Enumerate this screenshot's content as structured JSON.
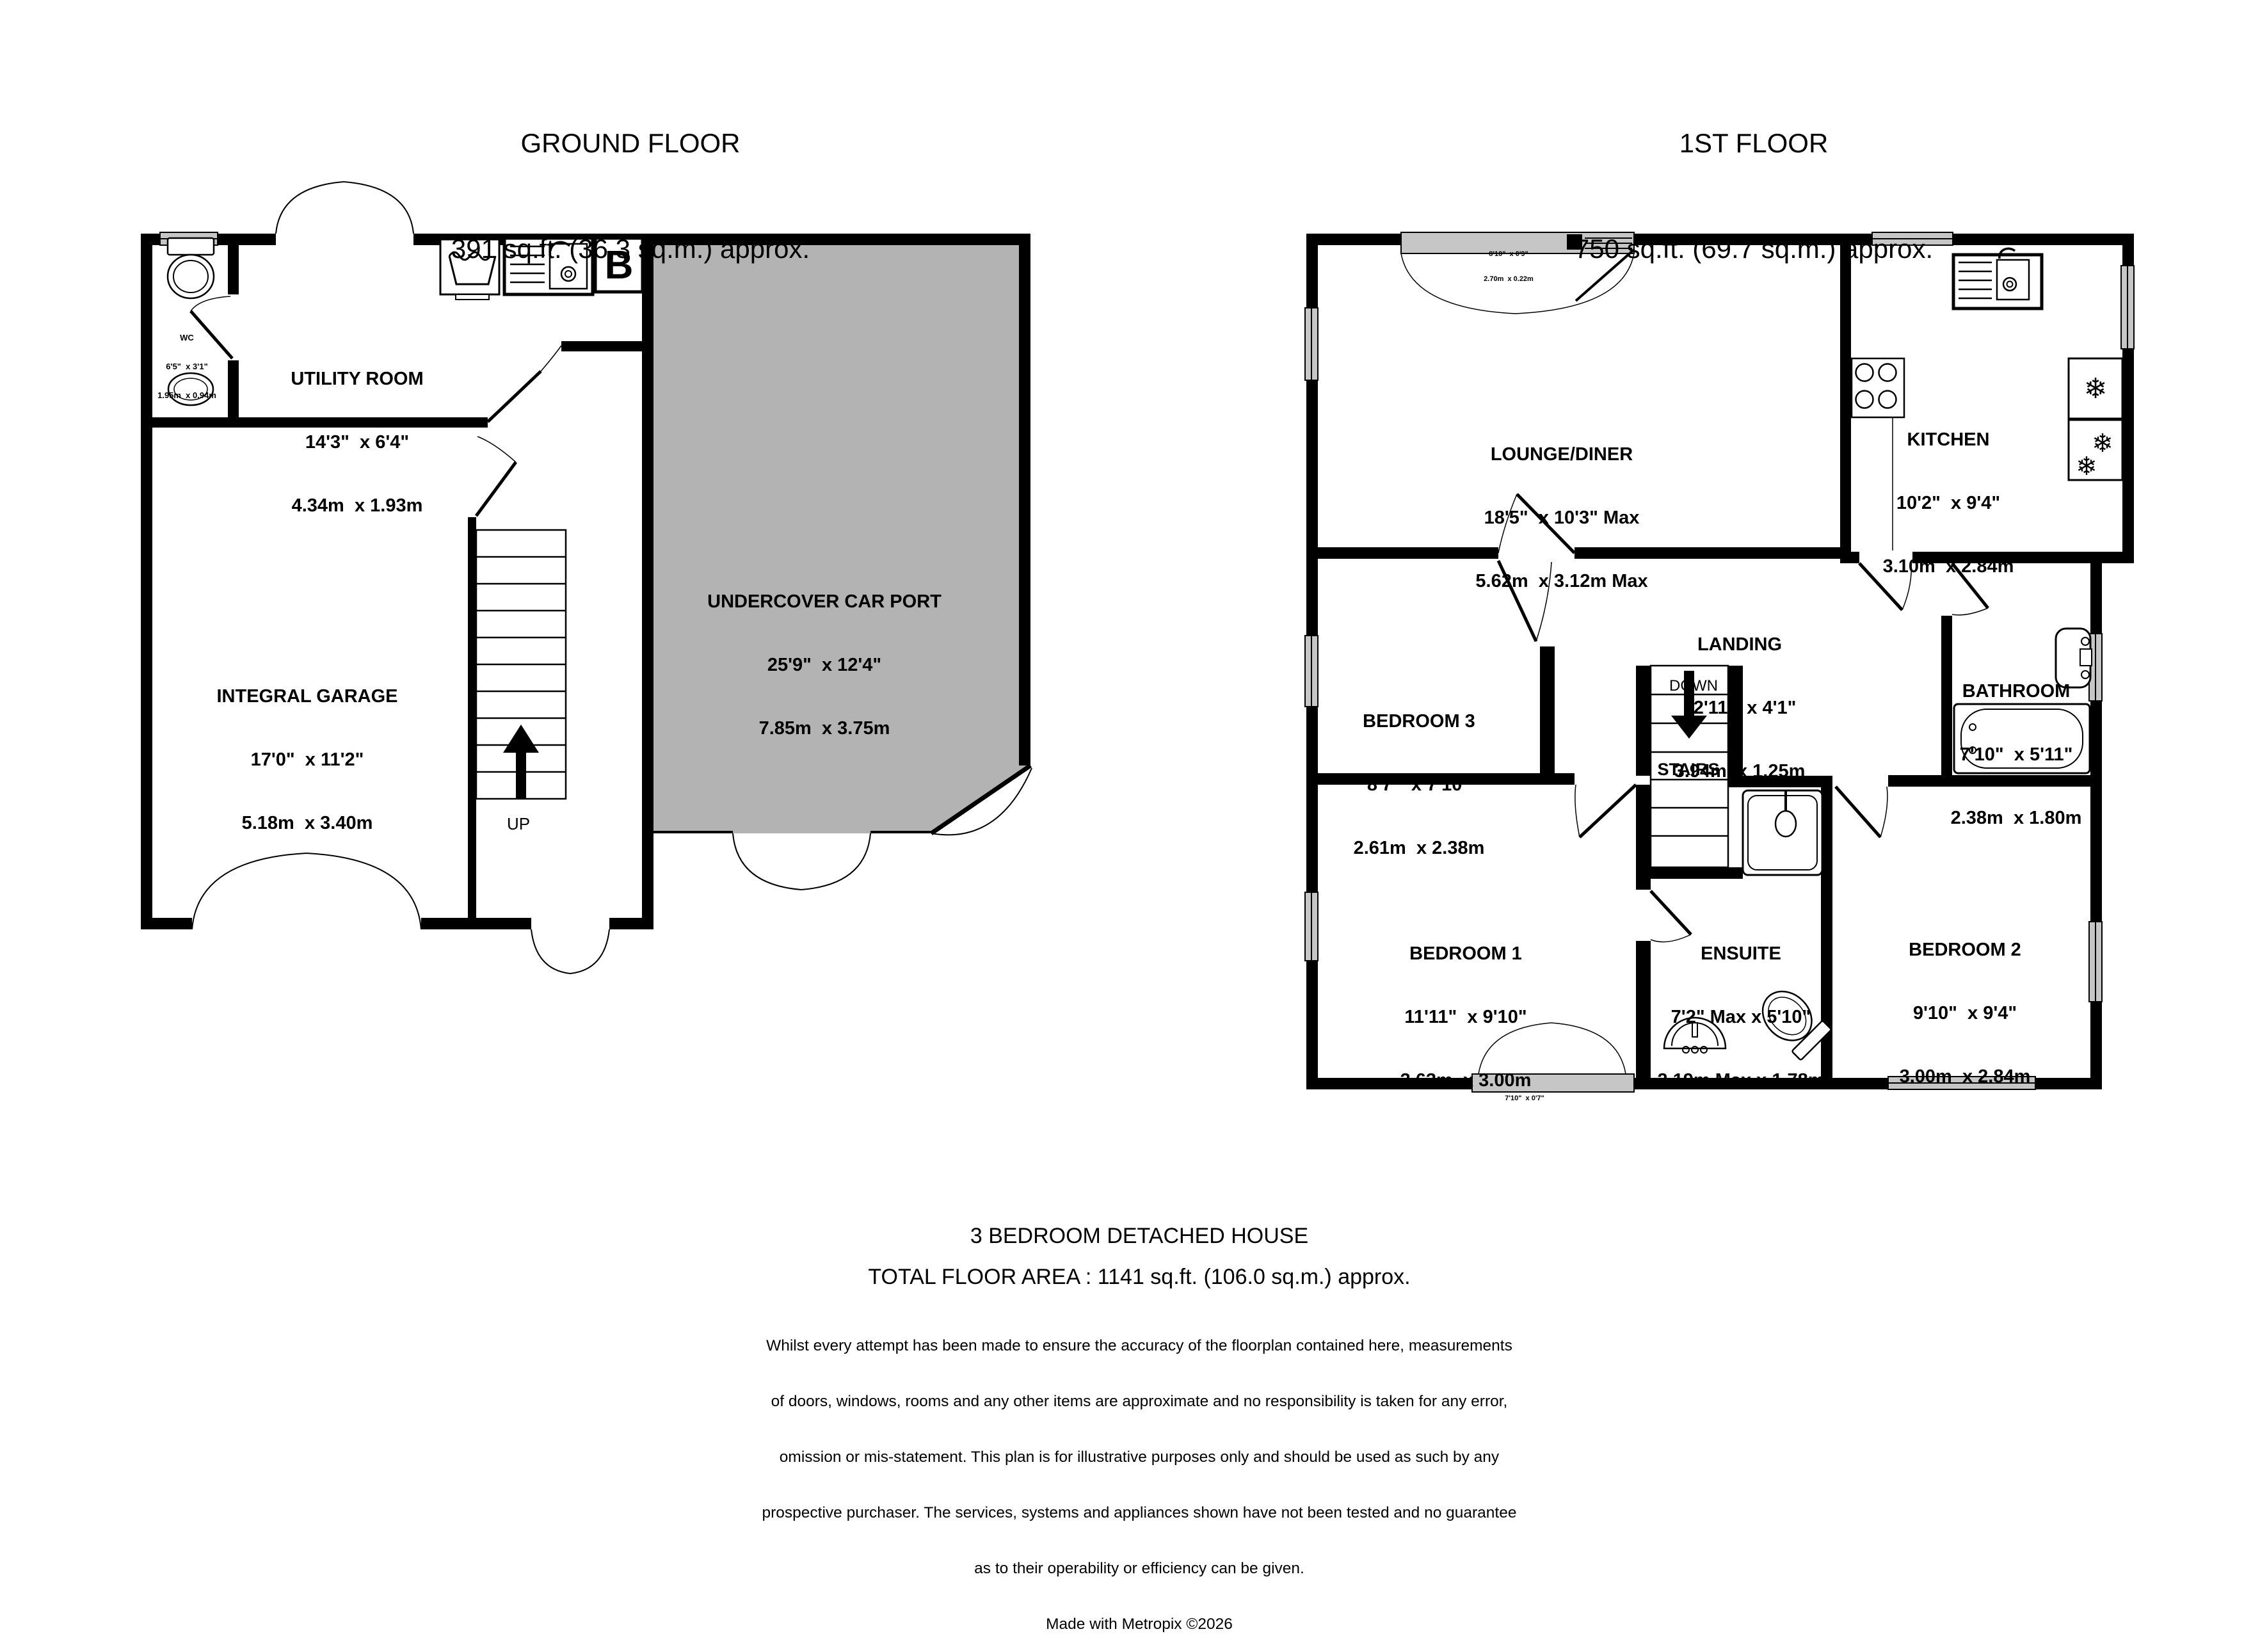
{
  "colors": {
    "wall": "#000000",
    "carport_fill": "#b3b3b3",
    "window_fill": "#c6c6c6",
    "text": "#000000"
  },
  "ground_floor": {
    "title": "GROUND FLOOR",
    "area": "391 sq.ft. (36.3 sq.m.) approx.",
    "rooms": {
      "wc": {
        "name": "WC",
        "imperial": "6'5\"  x 3'1\"",
        "metric": "1.95m  x 0.94m"
      },
      "utility_room": {
        "name": "UTILITY ROOM",
        "imperial": "14'3\"  x 6'4\"",
        "metric": "4.34m  x 1.93m"
      },
      "integral_garage": {
        "name": "INTEGRAL GARAGE",
        "imperial": "17'0\"  x 11'2\"",
        "metric": "5.18m  x 3.40m"
      },
      "car_port": {
        "name": "UNDERCOVER CAR PORT",
        "imperial": "25'9\"  x 12'4\"",
        "metric": "7.85m  x 3.75m"
      }
    },
    "stair_direction": "UP",
    "boiler": "B"
  },
  "first_floor": {
    "title": "1ST FLOOR",
    "area": "750 sq.ft. (69.7 sq.m.) approx.",
    "rooms": {
      "lounge_diner": {
        "name": "LOUNGE/DINER",
        "imperial": "18'5\"  x 10'3\" Max",
        "metric": "5.62m  x 3.12m Max"
      },
      "kitchen": {
        "name": "KITCHEN",
        "imperial": "10'2\"  x 9'4\"",
        "metric": "3.10m  x 2.84m"
      },
      "bedroom3": {
        "name": "BEDROOM 3",
        "imperial": "8'7\"  x 7'10\"",
        "metric": "2.61m  x 2.38m"
      },
      "landing": {
        "name": "LANDING",
        "imperial": "12'11\"  x 4'1\"",
        "metric": "3.94m  x 1.25m"
      },
      "bathroom": {
        "name": "BATHROOM",
        "imperial": "7'10\"  x 5'11\"",
        "metric": "2.38m  x 1.80m"
      },
      "bedroom1": {
        "name": "BEDROOM 1",
        "imperial": "11'11\"  x 9'10\"",
        "metric": "3.63m  x 3.00m"
      },
      "ensuite": {
        "name": "ENSUITE",
        "imperial": "7'2\" Max x 5'10\"",
        "metric": "2.19m Max x 1.78m"
      },
      "bedroom2": {
        "name": "BEDROOM 2",
        "imperial": "9'10\"  x 9'4\"",
        "metric": "3.00m  x 2.84m"
      }
    },
    "stairs_label": "STAIRS",
    "stair_direction": "DOWN",
    "bay_window_top": {
      "imperial": "8'10\"  x 0'9\"",
      "metric": "2.70m  x 0.22m"
    },
    "bay_window_bottom": {
      "imperial": "7'10\"  x 0'7\""
    }
  },
  "icons": {
    "snowflake": "❄"
  },
  "footer": {
    "property_type": "3 BEDROOM DETACHED HOUSE",
    "total_area": "TOTAL FLOOR AREA : 1141 sq.ft. (106.0 sq.m.) approx.",
    "disclaimer_lines": [
      "Whilst every attempt has been made to ensure the accuracy of the floorplan contained here, measurements",
      "of doors, windows, rooms and any other items are approximate and no responsibility is taken for any error,",
      "omission or mis-statement. This plan is for illustrative purposes only and should be used as such by any",
      "prospective purchaser. The services, systems and appliances shown have not been tested and no guarantee",
      "as to their operability or efficiency can be given."
    ],
    "credit": "Made with Metropix ©2026"
  }
}
